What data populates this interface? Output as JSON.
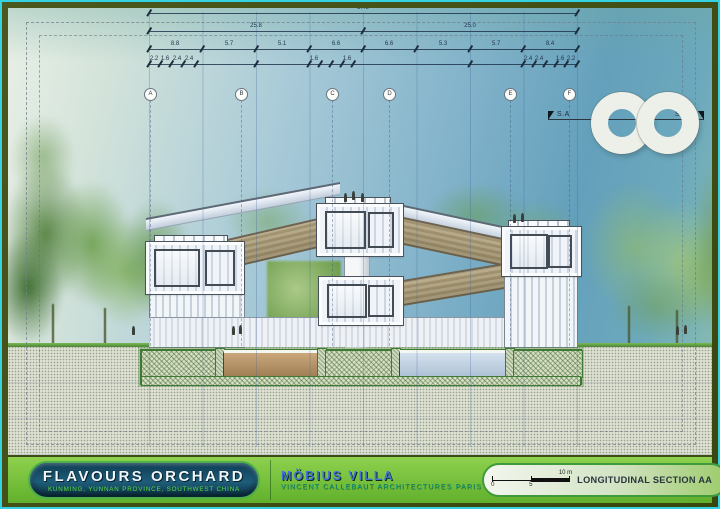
{
  "titlebar": {
    "project": "FLAVOURS ORCHARD",
    "location": "KUNMING, YUNNAN PROVINCE, SOUTHWEST CHINA",
    "villa": "MÖBIUS VILLA",
    "firm": "VINCENT CALLEBAUT ARCHITECTURES PARIS",
    "drawing_label": "LONGITUDINAL SECTION AA",
    "scale": {
      "zero": "0",
      "five": "5",
      "ten": "10 m"
    }
  },
  "section_marker": {
    "left": "S.A",
    "right": "S.A'"
  },
  "annotations": {
    "grid_bubbles": [
      {
        "x": 142,
        "label": "A"
      },
      {
        "x": 233,
        "label": "B"
      },
      {
        "x": 324,
        "label": "C"
      },
      {
        "x": 381,
        "label": "D"
      },
      {
        "x": 502,
        "label": "E"
      },
      {
        "x": 561,
        "label": "F"
      }
    ],
    "dimension_levels": [
      {
        "y": 5,
        "x1": 141,
        "x2": 569,
        "ticks": [
          141,
          569
        ],
        "labels": [
          {
            "x": 355,
            "text": "57.3"
          }
        ]
      },
      {
        "y": 23,
        "x1": 141,
        "x2": 569,
        "ticks": [
          141,
          355,
          569
        ],
        "labels": [
          {
            "x": 248,
            "text": "25.8"
          },
          {
            "x": 462,
            "text": "25.0"
          }
        ]
      },
      {
        "y": 41,
        "x1": 141,
        "x2": 569,
        "ticks": [
          141,
          194,
          248,
          301,
          355,
          408,
          462,
          515,
          569
        ],
        "labels": [
          {
            "x": 167,
            "text": "8.8"
          },
          {
            "x": 221,
            "text": "5.7"
          },
          {
            "x": 274,
            "text": "5.1"
          },
          {
            "x": 328,
            "text": "6.6"
          },
          {
            "x": 381,
            "text": "6.6"
          },
          {
            "x": 435,
            "text": "5.3"
          },
          {
            "x": 488,
            "text": "5.7"
          },
          {
            "x": 542,
            "text": "8.4"
          }
        ]
      },
      {
        "y": 56,
        "x1": 141,
        "x2": 569,
        "ticks": [
          141,
          152,
          163,
          175,
          188,
          248,
          301,
          312,
          323,
          334,
          345,
          462,
          515,
          526,
          537,
          548,
          558,
          569
        ],
        "labels": [
          {
            "x": 146,
            "text": "2.2"
          },
          {
            "x": 157,
            "text": "1.6"
          },
          {
            "x": 169,
            "text": "2.4"
          },
          {
            "x": 181,
            "text": "2.4"
          },
          {
            "x": 306,
            "text": "1.6"
          },
          {
            "x": 339,
            "text": "1.6"
          },
          {
            "x": 520,
            "text": "2.4"
          },
          {
            "x": 531,
            "text": "2.4"
          },
          {
            "x": 552,
            "text": "1.6"
          },
          {
            "x": 563,
            "text": "2.2"
          }
        ]
      }
    ]
  },
  "colors": {
    "border_cyan": "#35d2e4",
    "frame_olive": "#44511b",
    "strip_green": "#76c23c",
    "pill_navy": "#124157",
    "title_white": "#f1f6fa",
    "subtitle_green": "#5bdb3b",
    "villa_blue": "#4273dc",
    "firm_teal": "#12997b",
    "sky_blue": "#6fa9c2",
    "ground_gray": "#dde1d2"
  }
}
